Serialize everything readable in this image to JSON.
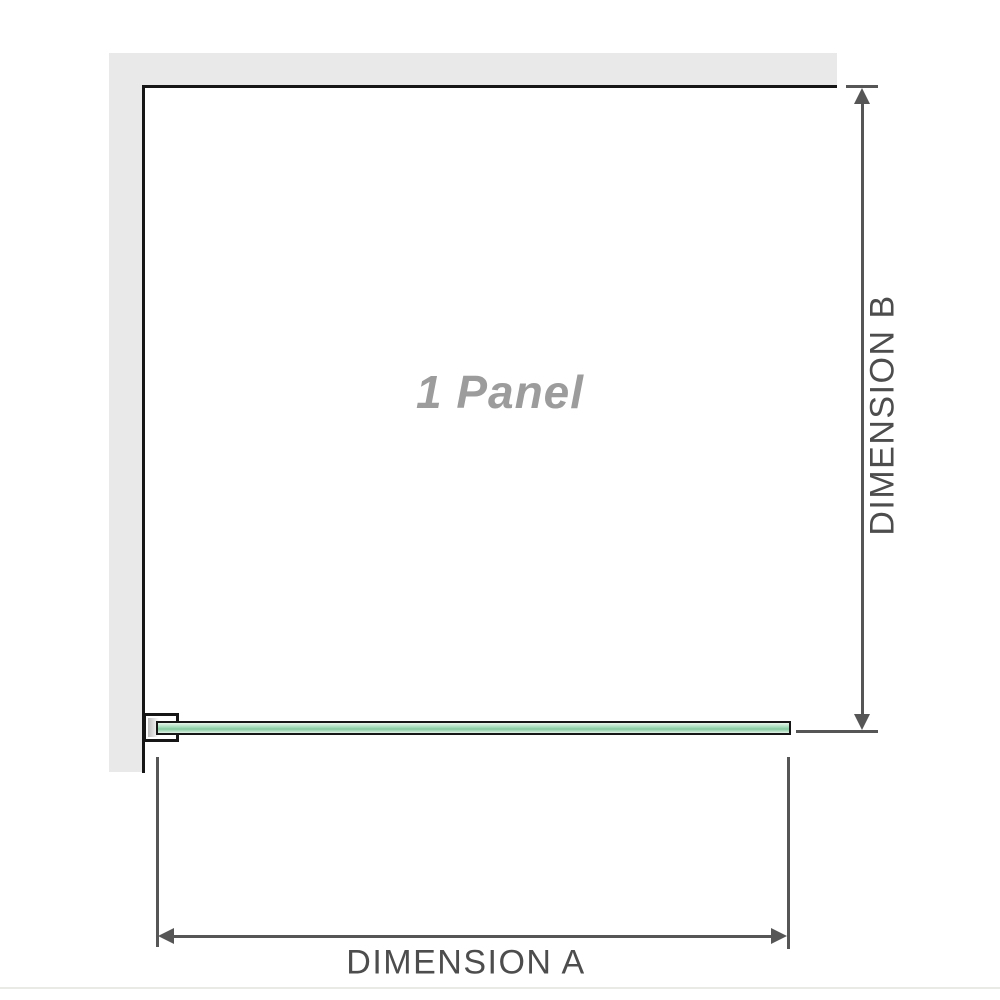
{
  "diagram": {
    "panel_label": "1 Panel",
    "dimension_a": {
      "label": "DIMENSION A",
      "orientation": "horizontal",
      "measures": "panel width"
    },
    "dimension_b": {
      "label": "DIMENSION B",
      "orientation": "vertical",
      "measures": "panel height"
    }
  },
  "colors": {
    "wall_gray": "#e9e9e9",
    "panel_border_black": "#161616",
    "dimension_line_gray": "#565656",
    "dimension_text_gray": "#4d4d4d",
    "panel_label_gray": "#9c9c9c",
    "glass_green_main": "#99d5b0",
    "glass_green_dark": "#84c89e",
    "glass_green_light": "#e8f5ec",
    "baseline_gray": "#e9e9e5"
  }
}
